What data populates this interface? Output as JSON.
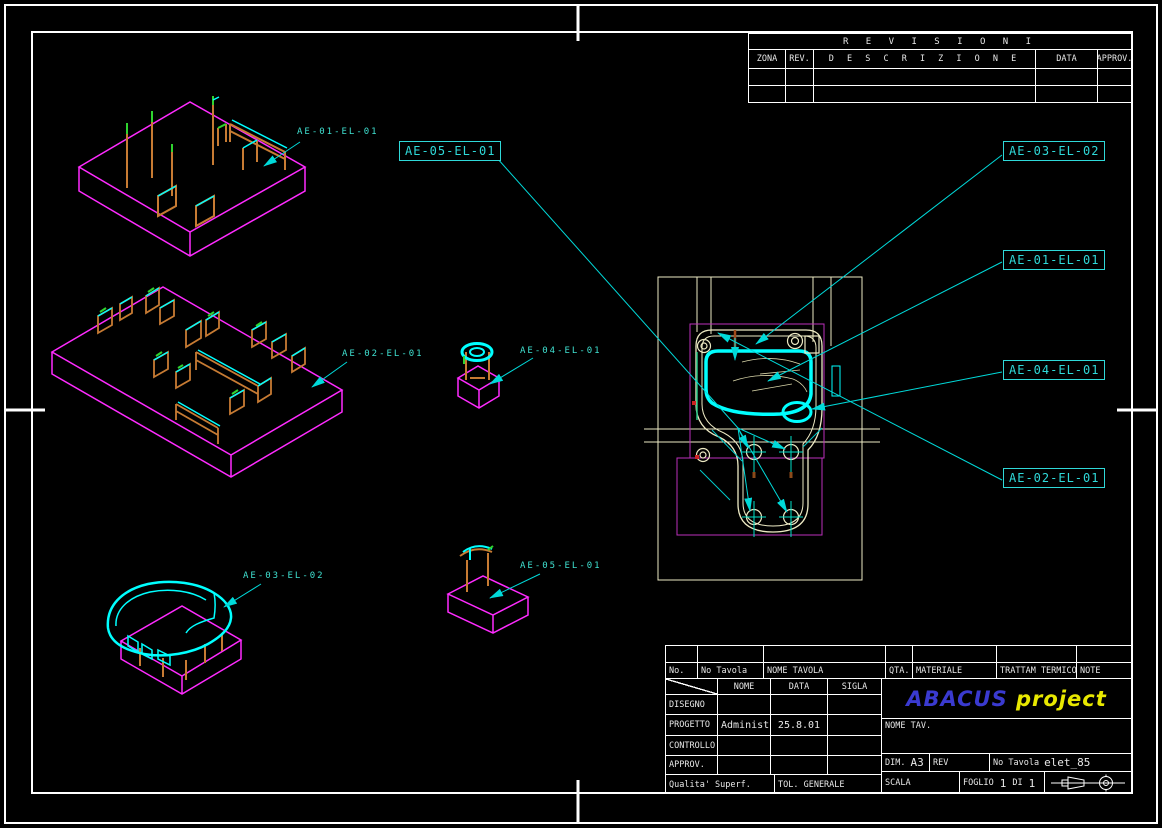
{
  "colors": {
    "board_magenta": "#ff2bff",
    "part_cyan": "#00ffff",
    "label_cyan": "#2fd9d9",
    "component_orange": "#c77b33",
    "component_green": "#2fd32f",
    "drawing_cream": "#edeac4",
    "frame_white": "#ffffff",
    "brand_blue": "#3a3ad0",
    "brand_yellow": "#e8e800"
  },
  "revisions": {
    "title": "R E V I S I O N I",
    "headers": [
      "ZONA",
      "REV.",
      "D E S C R I Z I O N E",
      "DATA",
      "APPROV."
    ]
  },
  "part_labels": {
    "boxed": [
      {
        "text": "AE-05-EL-01"
      },
      {
        "text": "AE-03-EL-02"
      },
      {
        "text": "AE-01-EL-01"
      },
      {
        "text": "AE-04-EL-01"
      },
      {
        "text": "AE-02-EL-01"
      }
    ],
    "plain": [
      {
        "text": "AE-01-EL-01"
      },
      {
        "text": "AE-02-EL-01"
      },
      {
        "text": "AE-04-EL-01"
      },
      {
        "text": "AE-03-EL-02"
      },
      {
        "text": "AE-05-EL-01"
      }
    ]
  },
  "title_block": {
    "parts_header": [
      "No.",
      "No  Tavola",
      "NOME  TAVOLA",
      "QTA.",
      "MATERIALE",
      "TRATTAM  TERMICO",
      "NOTE"
    ],
    "approval": {
      "col_nome": "NOME",
      "col_data": "DATA",
      "col_sigla": "SIGLA",
      "row_disegno": "DISEGNO",
      "row_progetto": "PROGETTO",
      "row_controllo": "CONTROLLO",
      "row_approv": "APPROV.",
      "progetto_nome": "Administra",
      "progetto_data": "25.8.01",
      "qualita": "Qualita'  Superf.",
      "tol": "TOL.  GENERALE"
    },
    "brand_1": "ABACUS",
    "brand_2": "project",
    "nome_tav": "NOME  TAV.",
    "dim_label": "DIM.",
    "dim_value": "A3",
    "rev_label": "REV",
    "no_tavola_label": "No  Tavola",
    "no_tavola_value": "elet_85",
    "scala_label": "SCALA",
    "foglio_label": "FOGLIO",
    "foglio_n": "1",
    "di_label": "DI",
    "foglio_tot": "1"
  }
}
